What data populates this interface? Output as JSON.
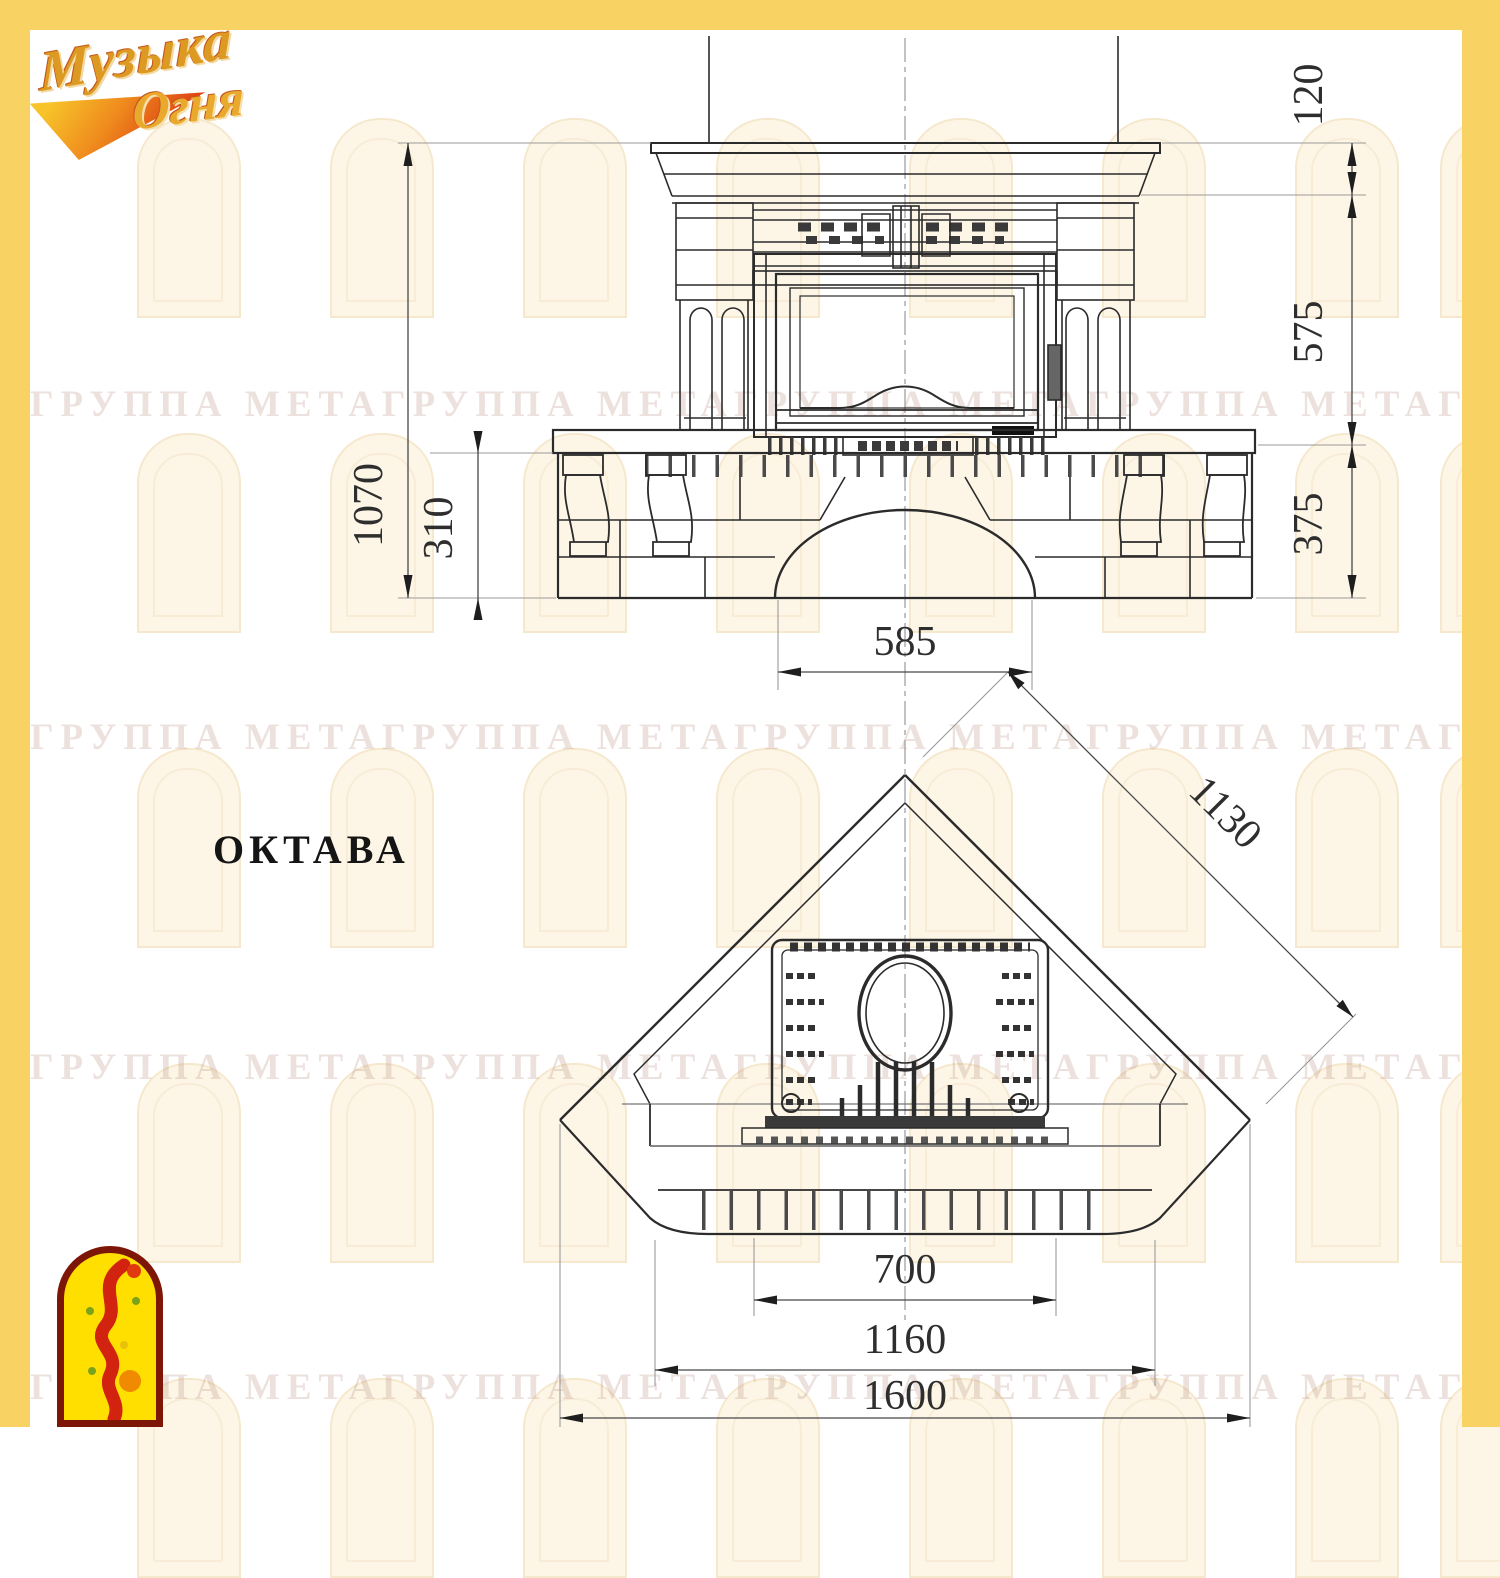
{
  "header": {
    "brand_line1": "Музыка",
    "brand_line2": "Огня"
  },
  "title": "ОКТАВА",
  "watermark": {
    "text": "ГРУППА МЕТА",
    "rows_top": [
      383,
      716,
      1046,
      1366
    ],
    "repeats": 6
  },
  "front": {
    "dim_total_height": "1070",
    "dim_chimney": "120",
    "dim_opening": "575",
    "dim_base": "375",
    "dim_hearth": "310",
    "dim_arch_width": "585"
  },
  "plan": {
    "dim_diagonal": "1130",
    "dim_firebox": "700",
    "dim_hearth_width": "1160",
    "dim_total_width": "1600"
  },
  "colors": {
    "frame_yellow": "#f8d263",
    "line_dark": "#2b2b2b",
    "line_aux": "#9a9a9a",
    "watermark_text": "rgba(167,118,99,0.22)",
    "arch_fill": "#fdf6e7",
    "stamp_red": "#d1230f",
    "stamp_yellow": "#ffdf00"
  }
}
